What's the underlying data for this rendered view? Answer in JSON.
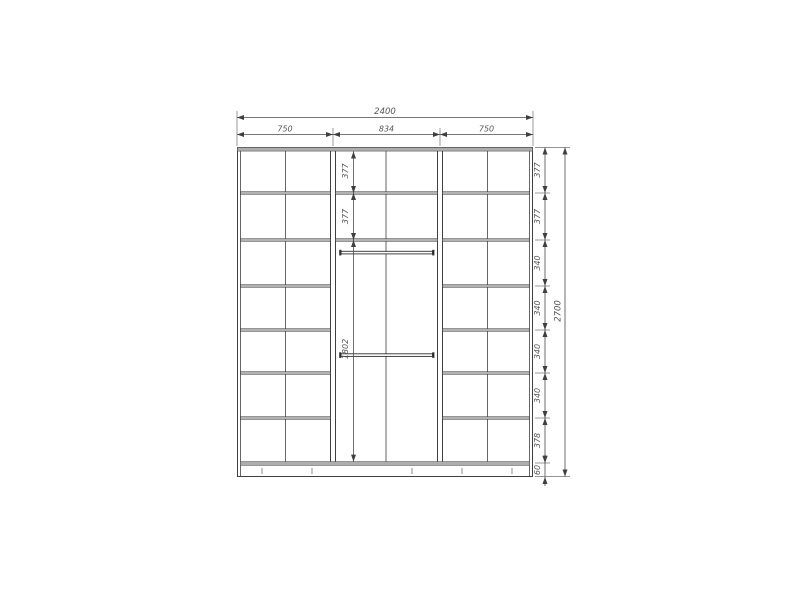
{
  "drawing": {
    "kind": "wardrobe-front-elevation-dimension-drawing",
    "dims": {
      "top": {
        "total": "2400",
        "sections": [
          "750",
          "834",
          "750"
        ]
      },
      "middle_chain": [
        "377",
        "377",
        "1802"
      ],
      "right_chain": [
        "377",
        "377",
        "340",
        "340",
        "340",
        "340",
        "378",
        "60"
      ],
      "right_total": "2700"
    },
    "colors": {
      "background": "#ffffff",
      "thin_line": "#3f3f3f",
      "panel_gray": "#adadad",
      "shelf_gray": "#c6c6c6",
      "dim_line": "#4a4a4a",
      "dim_text": "#555555"
    }
  }
}
